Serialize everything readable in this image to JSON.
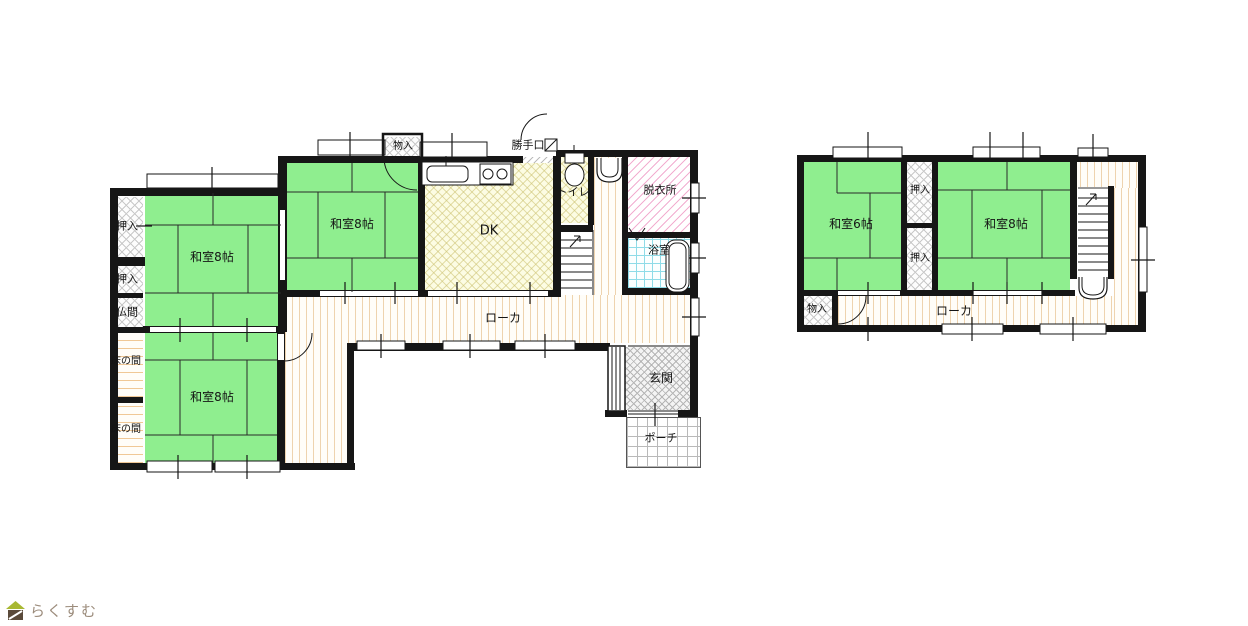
{
  "floor1": {
    "washitsu_nw": "和室8帖",
    "washitsu_mid": "和室8帖",
    "washitsu_sw": "和室8帖",
    "dk": "DK",
    "toilet": "トイレ",
    "datsuijo": "脱衣所",
    "yokushitsu": "浴室",
    "oshiire_1": "押入",
    "oshiire_2": "押入",
    "butsuma": "仏間",
    "tokonoma_1": "床の間",
    "tokonoma_2": "床の間",
    "monoire": "物入",
    "katteguchi": "勝手口",
    "roka": "ローカ",
    "genkan": "玄関",
    "porch": "ポーチ"
  },
  "floor2": {
    "washitsu_6": "和室6帖",
    "washitsu_8": "和室8帖",
    "oshiire_top": "押入",
    "oshiire_bottom": "押入",
    "monoire": "物入",
    "roka": "ローカ"
  },
  "logo": {
    "text": "らくすむ"
  },
  "colors": {
    "tatami": "#8fee8f",
    "dk_fill": "#fcfce3",
    "bath_line": "#8fdce8",
    "datsui_line": "#f2aed0",
    "corridor_line": "#eed3ae",
    "wall": "#161616",
    "logo_text": "#9c8c7c",
    "logo_roof": "#a8b832",
    "logo_body": "#5a4a3a"
  }
}
